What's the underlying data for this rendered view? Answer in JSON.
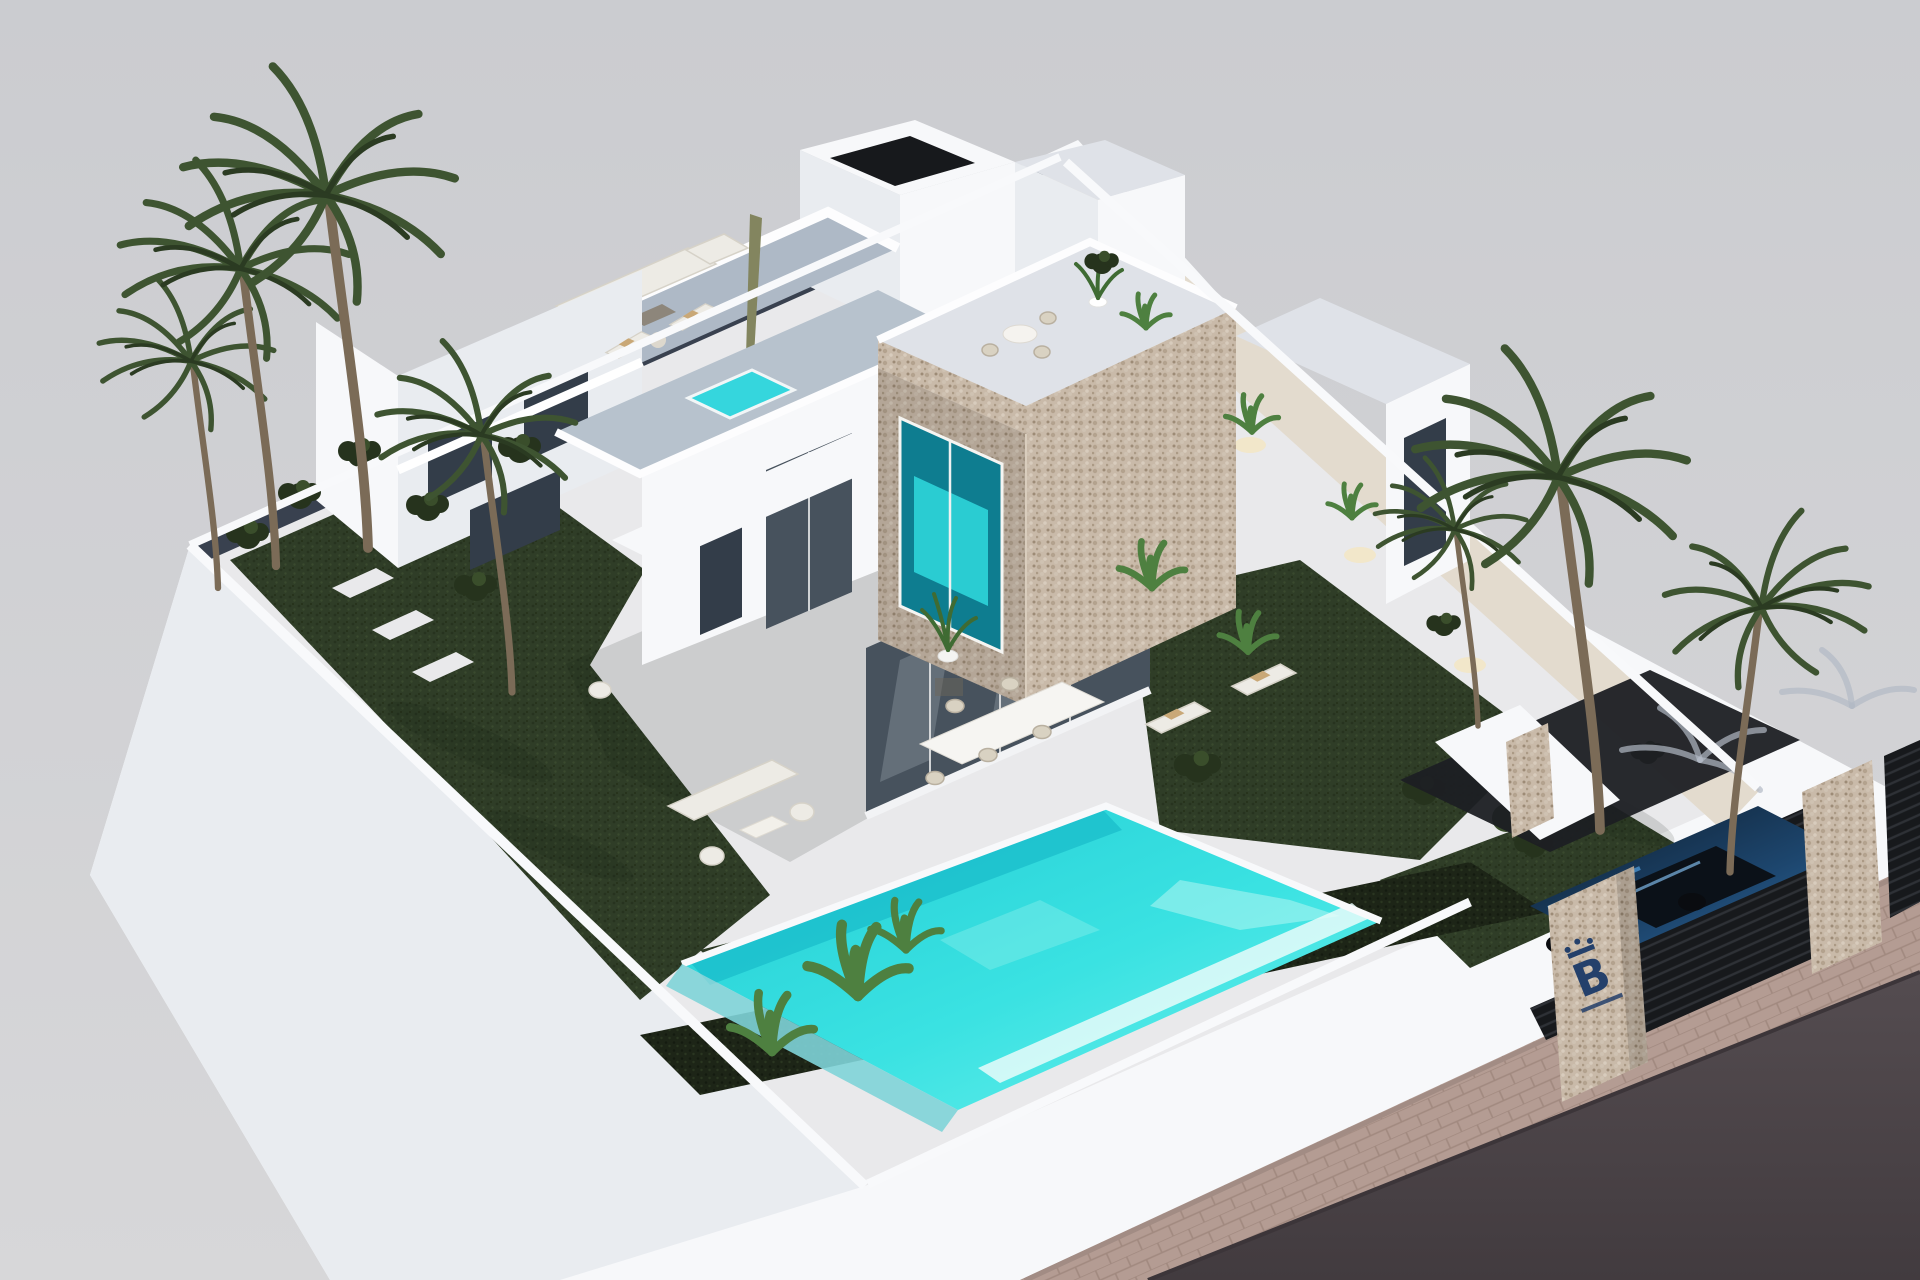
{
  "scene": {
    "type": "architectural-3d-render",
    "view": "aerial-isometric",
    "subject": "Modern two-storey white villa with stone-clad cube volume, roof terraces, garden and private pool",
    "setting": "Walled corner plot presented as a floating white model base over a grey background, with street and sidewalk at lower right"
  },
  "branding": {
    "gate_logo_letter": "B",
    "gate_logo_color": "#24406b",
    "gate_logo_has_crown": true,
    "gate_logo_subtext_illegible": true,
    "location": "stone pillar at entrance gate"
  },
  "objects": [
    "two-storey white villa",
    "stone-clad cantilevered cube with picture window",
    "rooftop stair tower",
    "roof terrace with outdoor sofa and closed parasol",
    "roof terrace with sun loungers and plunge pool",
    "cube roof terrace with round table, chairs and potted plant",
    "ground floor glass walls with interior dining room",
    "outdoor dining table with wicker chairs",
    "garden lounge set on lawn",
    "two poolside sun loungers with towels",
    "turquoise swimming pool with overflow edge",
    "dark trimmed hedge along street boundary",
    "artificial grass lawns",
    "palm trees and banana plants",
    "side path with uplights along boundary wall",
    "driveway with dark blue car under carport",
    "dark slatted entrance gate with stone pillars",
    "branded stone pillar",
    "paved sidewalk and asphalt road"
  ],
  "palette": {
    "bg": "#cdced2",
    "wall_white": "#f7f8fa",
    "wall_shade": "#e9ecf0",
    "paving": "#e9e9eb",
    "lawn": "#2f3d27",
    "hedge": "#1d2517",
    "pool": "#2bdce0",
    "pool_deep": "#14b6c6",
    "stone": "#c9baa9",
    "glass": "#47525d",
    "road": "#4b4347",
    "sidewalk": "#b49c93",
    "gate": "#17191c",
    "car_blue": "#2f6da5",
    "palm": "#3e5431",
    "trunk": "#7b6b57",
    "furniture": "#edebe5",
    "towel": "#c9a877",
    "floor_terrace": "#aeb9c6",
    "path_light": "#e3dbce",
    "light_glow": "#f3e6c4",
    "inner_wall": "#39414f",
    "logo": "#24406b"
  }
}
